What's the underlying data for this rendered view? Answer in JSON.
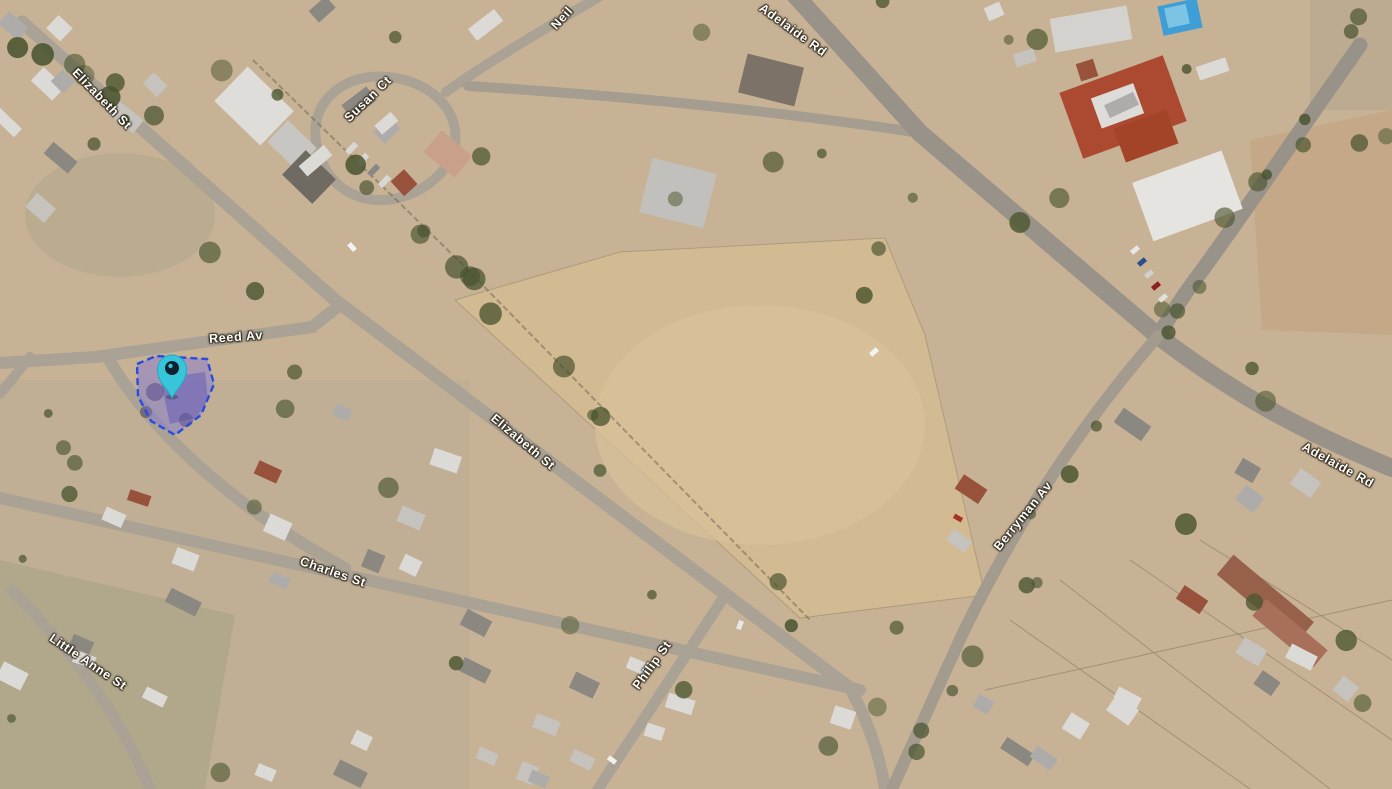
{
  "map": {
    "view_type": "satellite-aerial",
    "street_labels": [
      {
        "id": "elizabeth-st-nw",
        "text": "Elizabeth St"
      },
      {
        "id": "susan-ct",
        "text": "Susan Ct"
      },
      {
        "id": "neil-st-partial",
        "text": "Neil"
      },
      {
        "id": "adelaide-rd-north",
        "text": "Adelaide Rd"
      },
      {
        "id": "reed-av",
        "text": "Reed Av"
      },
      {
        "id": "elizabeth-st-central",
        "text": "Elizabeth St"
      },
      {
        "id": "adelaide-rd-east",
        "text": "Adelaide Rd"
      },
      {
        "id": "berryman-av",
        "text": "Berryman Av"
      },
      {
        "id": "charles-st",
        "text": "Charles St"
      },
      {
        "id": "little-anne-st",
        "text": "Little Anne St"
      },
      {
        "id": "philip-st",
        "text": "Philip St"
      }
    ],
    "marker": {
      "name": "location-pin",
      "color": "#38c5da",
      "inner_color": "#0d222e"
    },
    "selected_parcel": {
      "fill_color": "#7a71de",
      "stroke_color": "#2a4be0",
      "border_style": "dashed"
    }
  }
}
